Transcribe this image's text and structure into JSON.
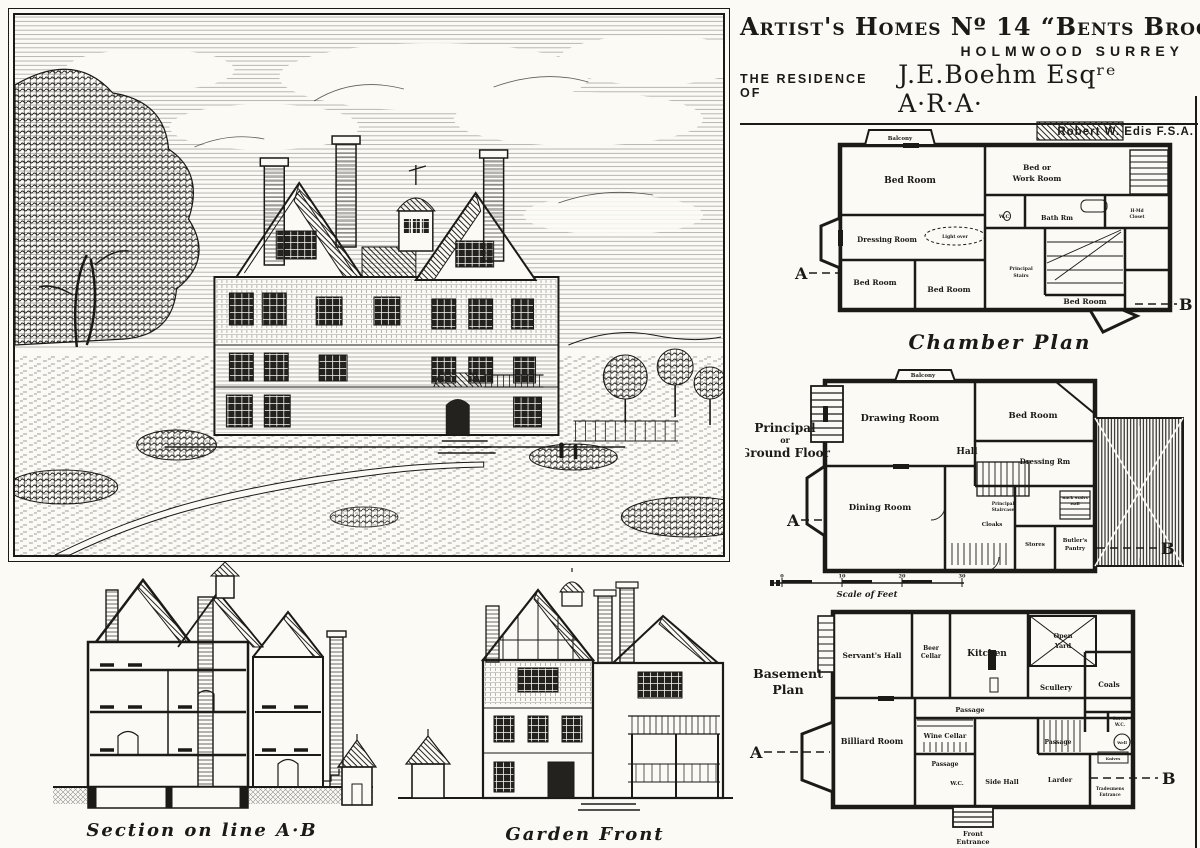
{
  "ink": "#1c1a17",
  "paper": "#fbfaf5",
  "title_block": {
    "line1": "Artist's Homes  Nº 14  “Bents Brook”",
    "line2": "Holmwood  Surrey",
    "line3_prefix": "The Residence of",
    "line3_name": "J.E.Boehm Esqʳᵉ A·R·A·"
  },
  "architect": {
    "name": "Robert W. Edis  F.S.A.",
    "role": "Architect"
  },
  "section_markers": {
    "a": "A",
    "b": "B"
  },
  "plans": {
    "chamber": {
      "caption": "Chamber Plan",
      "rooms": {
        "balcony": "Balcony",
        "bed_main": "Bed Room",
        "bed_or_work_1": "Bed or",
        "bed_or_work_2": "Work Room",
        "dressing": "Dressing Room",
        "bed_sw": "Bed Room",
        "bed_s": "Bed Room",
        "bed_se": "Bed Room",
        "wc": "W.C.",
        "bath": "Bath Rm",
        "closet_1": "H·Md",
        "closet_2": "Closet",
        "stairs_1": "Principal",
        "stairs_2": "Stairs",
        "light_over": "Light over"
      }
    },
    "ground": {
      "label_1": "Principal",
      "label_2": "or",
      "label_3": "Ground Floor",
      "rooms": {
        "balcony": "Balcony",
        "drawing": "Drawing Room",
        "bed": "Bed Room",
        "dressing": "Dressing Rm",
        "dining": "Dining Room",
        "hall": "Hall",
        "principal_stairs_1": "Principal",
        "principal_stairs_2": "Staircase",
        "cloaks": "Cloaks",
        "stores": "Stores",
        "butlers_1": "Butler's",
        "butlers_2": "Pantry",
        "back_stairs_1": "Back Stairs",
        "back_stairs_2": "Hall"
      }
    },
    "basement": {
      "label_1": "Basement",
      "label_2": "Plan",
      "rooms": {
        "servants_hall": "Servant's Hall",
        "beer_1": "Beer",
        "beer_2": "Cellar",
        "kitchen": "Kitchen",
        "open_yard_1": "Open",
        "open_yard_2": "Yard",
        "scullery": "Scullery",
        "coals": "Coals",
        "passage_kitchen": "Passage",
        "wine_cellar": "Wine Cellar",
        "billiard": "Billiard Room",
        "passage_center": "Passage",
        "passage_right": "Passage",
        "wc": "W.C.",
        "side_hall": "Side Hall",
        "larder": "Larder",
        "servants_wc_1": "Servts",
        "servants_wc_2": "W.C.",
        "well": "Well",
        "knives": "Knives",
        "front_entrance_1": "Front",
        "front_entrance_2": "Entrance",
        "tradesmens_1": "Tradesmens",
        "tradesmens_2": "Entrance"
      }
    }
  },
  "scale": {
    "label": "Scale of Feet",
    "ticks": [
      "0",
      "10",
      "20",
      "30"
    ]
  },
  "captions": {
    "section": "Section on line A·B",
    "garden_front": "Garden Front"
  }
}
